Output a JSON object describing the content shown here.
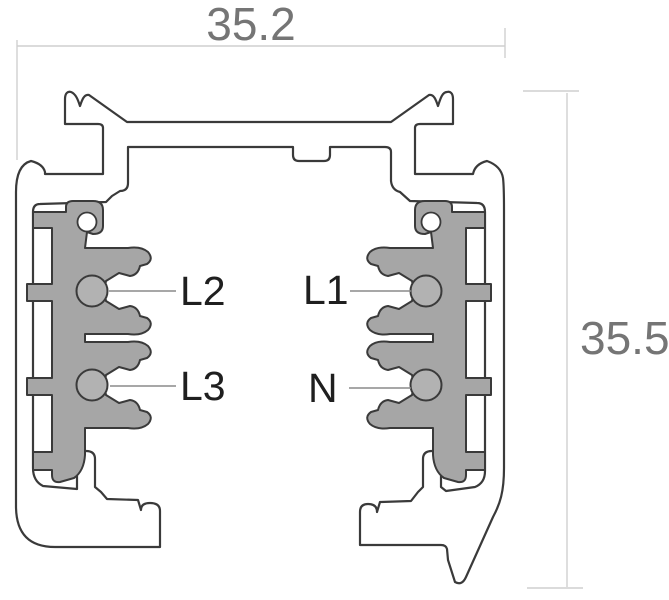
{
  "diagram": {
    "type": "track-profile-cross-section",
    "dimensions": {
      "width_label": "35.2",
      "height_label": "35.5"
    },
    "conductors": [
      {
        "label": "L2",
        "position": "upper-left"
      },
      {
        "label": "L3",
        "position": "lower-left"
      },
      {
        "label": "L1",
        "position": "upper-right"
      },
      {
        "label": "N",
        "position": "lower-right"
      }
    ],
    "colors": {
      "outline": "#3a3a3a",
      "profile_fill": "#ffffff",
      "insulator_fill": "#a6a6a6",
      "conductor_fill": "#b2b2b2",
      "label_text": "#1f1f1f",
      "dimension_text": "#757575",
      "dimension_line": "#cfcfcf",
      "background": "#ffffff"
    }
  }
}
